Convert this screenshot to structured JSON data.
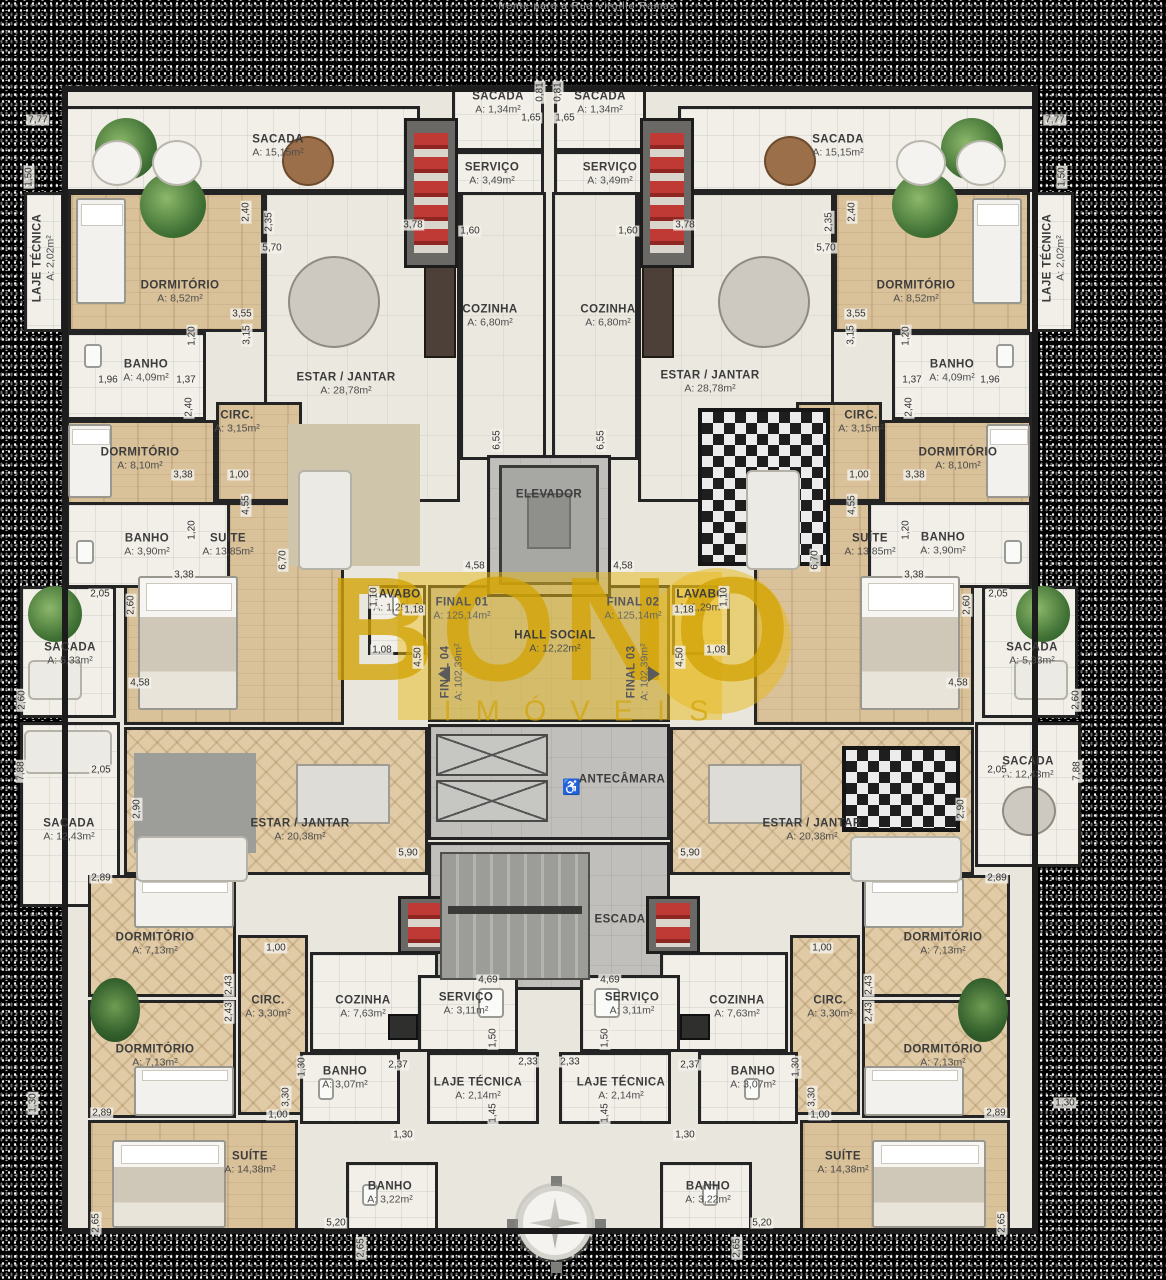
{
  "title": "frente para a Rua Virgílio Ramos",
  "watermark": {
    "brand": "BONO",
    "subbrand": "IMÓVEIS",
    "color": "#E0AF12"
  },
  "icons": {
    "wheelchair": "♿",
    "compass": "compass-rose"
  },
  "rooms": [
    {
      "label": "SACADA",
      "area": "A: 15,15m²"
    },
    {
      "label": "SACADA",
      "area": "A: 1,34m²"
    },
    {
      "label": "SERVIÇO",
      "area": "A: 3,49m²"
    },
    {
      "label": "COZINHA",
      "area": "A: 6,80m²"
    },
    {
      "label": "LAJE TÉCNICA",
      "area": "A: 2,02m²"
    },
    {
      "label": "DORMITÓRIO",
      "area": "A: 8,52m²"
    },
    {
      "label": "ESTAR / JANTAR",
      "area": "A: 28,78m²"
    },
    {
      "label": "BANHO",
      "area": "A: 4,09m²"
    },
    {
      "label": "CIRC.",
      "area": "A: 3,15m²"
    },
    {
      "label": "DORMITÓRIO",
      "area": "A: 8,10m²"
    },
    {
      "label": "BANHO",
      "area": "A: 3,90m²"
    },
    {
      "label": "SUÍTE",
      "area": "A: 13,85m²"
    },
    {
      "label": "ELEVADOR"
    },
    {
      "label": "LAVABO",
      "area": "A: 1,29m²"
    },
    {
      "label": "HALL SOCIAL",
      "area": "A: 12,22m²"
    },
    {
      "label": "FINAL 01",
      "area": "A: 125,14m²"
    },
    {
      "label": "FINAL 02",
      "area": "A: 125,14m²"
    },
    {
      "label": "FINAL 03",
      "area": "A: 102,39m²"
    },
    {
      "label": "FINAL 04",
      "area": "A: 102,39m²"
    },
    {
      "label": "SACADA",
      "area": "A: 5,33m²"
    },
    {
      "label": "SACADA",
      "area": "A: 12,43m²"
    },
    {
      "label": "ESTAR / JANTAR",
      "area": "A: 20,38m²"
    },
    {
      "label": "ANTECÂMARA"
    },
    {
      "label": "ESCADA"
    },
    {
      "label": "DORMITÓRIO",
      "area": "A: 7,13m²"
    },
    {
      "label": "CIRC.",
      "area": "A: 3,30m²"
    },
    {
      "label": "COZINHA",
      "area": "A: 7,63m²"
    },
    {
      "label": "SERVIÇO",
      "area": "A: 3,11m²"
    },
    {
      "label": "LAJE TÉCNICA",
      "area": "A: 2,14m²"
    },
    {
      "label": "BANHO",
      "area": "A: 3,07m²"
    },
    {
      "label": "SUÍTE",
      "area": "A: 14,38m²"
    },
    {
      "label": "BANHO",
      "area": "A: 3,22m²"
    }
  ],
  "dims": [
    "7,77",
    "1,50",
    "0,81",
    "1,65",
    "3,78",
    "1,60",
    "2,35",
    "2,40",
    "5,70",
    "3,55",
    "3,15",
    "1,96",
    "1,37",
    "1,20",
    "3,38",
    "1,00",
    "4,55",
    "2,05",
    "2,60",
    "4,58",
    "6,55",
    "6,70",
    "1,10",
    "1,18",
    "1,08",
    "4,50",
    "5,90",
    "7,88",
    "2,90",
    "2,89",
    "2,43",
    "1,30",
    "3,30",
    "4,69",
    "2,37",
    "2,33",
    "1,45",
    "5,20",
    "2,65"
  ]
}
